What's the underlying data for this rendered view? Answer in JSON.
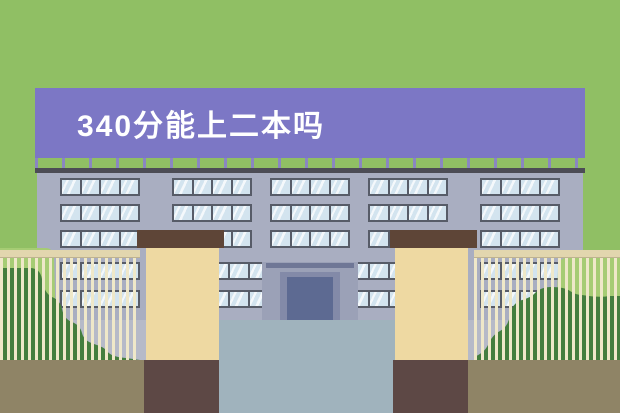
{
  "banner": {
    "title": "340分能上二本吗"
  },
  "scene": {
    "name": "flat-illustration-school-building-with-gate",
    "colors": {
      "background_green": "#90bf64",
      "banner_purple": "#7c77c5",
      "banner_text": "#ffffff",
      "post_purple": "#8a86c2",
      "roof_dark": "#4c4c55",
      "wall_gray": "#a9aec1",
      "window_glass": "#d3e4ef",
      "window_frame": "#575c68",
      "entrance_recess": "#9ba1b7",
      "entrance_lintel": "#6f7796",
      "door_frame": "#838aa8",
      "door_panel": "#5d6a92",
      "yard_gray": "#b6bac8",
      "path_gray": "#a0b3bd",
      "ground_olive": "#8f8466",
      "pillar_tan": "#eed9a2",
      "pillar_cap_brown": "#5e4537",
      "pillar_base_brown": "#5d4845",
      "fence_rail": "#e2d6ae",
      "fence_bar": "#efe8c9",
      "bush_dark": "#447e3e",
      "bush_light": "#a6cc74"
    },
    "windows": {
      "glass_rows": [
        {
          "y": 178,
          "h": 18,
          "groups": [
            {
              "x": 60,
              "w": 80,
              "panes": 4
            },
            {
              "x": 172,
              "w": 80,
              "panes": 4
            },
            {
              "x": 270,
              "w": 80,
              "panes": 4
            },
            {
              "x": 368,
              "w": 80,
              "panes": 4
            },
            {
              "x": 480,
              "w": 80,
              "panes": 4
            }
          ]
        },
        {
          "y": 204,
          "h": 18,
          "groups": [
            {
              "x": 60,
              "w": 80,
              "panes": 4
            },
            {
              "x": 172,
              "w": 80,
              "panes": 4
            },
            {
              "x": 270,
              "w": 80,
              "panes": 4
            },
            {
              "x": 368,
              "w": 80,
              "panes": 4
            },
            {
              "x": 480,
              "w": 80,
              "panes": 4
            }
          ]
        },
        {
          "y": 230,
          "h": 18,
          "groups": [
            {
              "x": 60,
              "w": 80,
              "panes": 4
            },
            {
              "x": 172,
              "w": 80,
              "panes": 4
            },
            {
              "x": 270,
              "w": 80,
              "panes": 4
            },
            {
              "x": 368,
              "w": 80,
              "panes": 4
            },
            {
              "x": 480,
              "w": 80,
              "panes": 4
            }
          ]
        },
        {
          "y": 262,
          "h": 18,
          "groups": [
            {
              "x": 60,
              "w": 80,
              "panes": 4
            },
            {
              "x": 172,
              "w": 80,
              "panes": 4
            },
            {
              "x": 228,
              "w": 164,
              "panes": 8
            },
            {
              "x": 368,
              "w": 80,
              "panes": 4
            },
            {
              "x": 480,
              "w": 80,
              "panes": 4
            }
          ]
        },
        {
          "y": 290,
          "h": 18,
          "groups": [
            {
              "x": 60,
              "w": 80,
              "panes": 4
            },
            {
              "x": 172,
              "w": 80,
              "panes": 4
            },
            {
              "x": 228,
              "w": 164,
              "panes": 8
            },
            {
              "x": 368,
              "w": 80,
              "panes": 4
            },
            {
              "x": 480,
              "w": 80,
              "panes": 4
            }
          ]
        }
      ]
    }
  }
}
